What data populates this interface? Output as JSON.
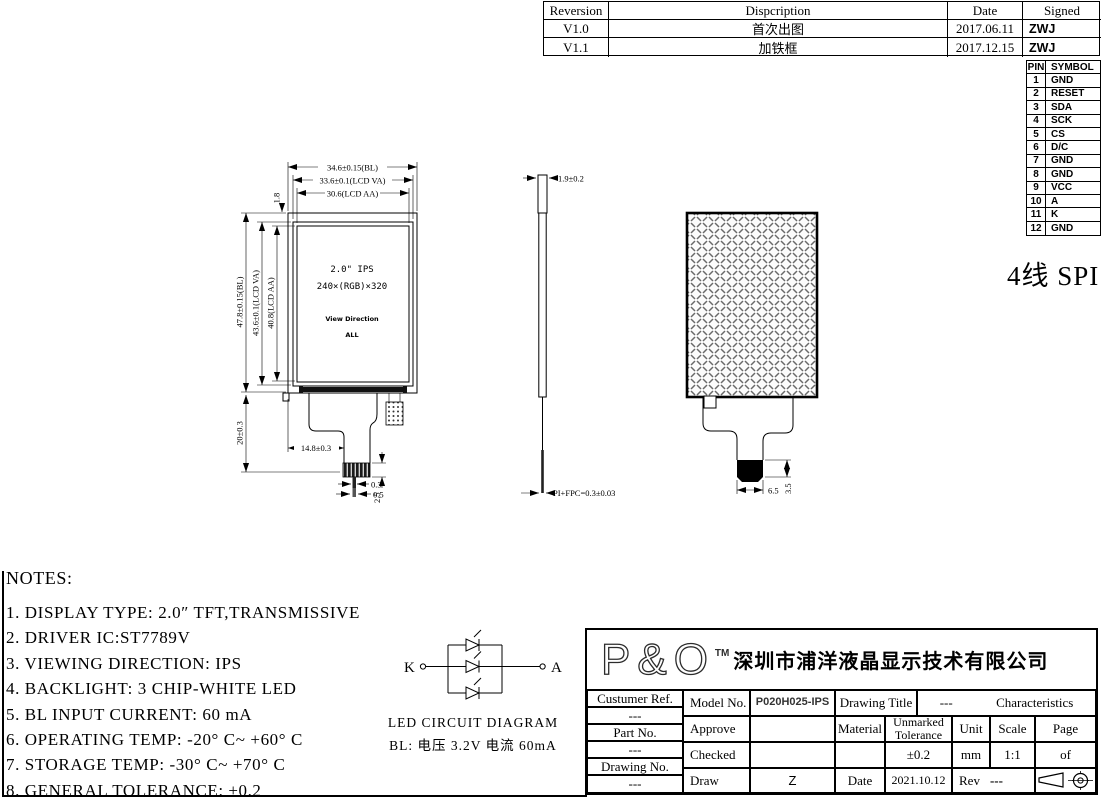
{
  "revision_table": {
    "headers": [
      "Reversion",
      "Dispcription",
      "Date",
      "Signed"
    ],
    "rows": [
      {
        "version": "V1.0",
        "description": "首次出图",
        "date": "2017.06.11",
        "signed": "ZWJ"
      },
      {
        "version": "V1.1",
        "description": "加铁框",
        "date": "2017.12.15",
        "signed": "ZWJ"
      }
    ]
  },
  "pin_table": {
    "pin_header": "PIN",
    "symbol_header": "SYMBOL",
    "pins": [
      [
        "1",
        "GND"
      ],
      [
        "2",
        "RESET"
      ],
      [
        "3",
        "SDA"
      ],
      [
        "4",
        "SCK"
      ],
      [
        "5",
        "CS"
      ],
      [
        "6",
        "D/C"
      ],
      [
        "7",
        "GND"
      ],
      [
        "8",
        "GND"
      ],
      [
        "9",
        "VCC"
      ],
      [
        "10",
        "A"
      ],
      [
        "11",
        "K"
      ],
      [
        "12",
        "GND"
      ]
    ]
  },
  "interface_label": "4线 SPI",
  "front_view": {
    "dim_width_bl": "34.6±0.15(BL)",
    "dim_width_va": "33.6±0.1(LCD VA)",
    "dim_width_aa": "30.6(LCD AA)",
    "dim_top": "1.8",
    "dim_height_bl": "47.8±0.15(BL)",
    "dim_height_va": "43.6±0.1(LCD VA)",
    "dim_height_aa": "40.8(LCD AA)",
    "dim_bottom": "20±0.3",
    "dim_fpc_offset": "14.8±0.3",
    "dim_fpc_w1": "0.3",
    "dim_fpc_w2": "0.5",
    "dim_fpc_len": "2.5",
    "label_size": "2.0\" IPS",
    "label_resolution": "240×(RGB)×320",
    "label_view_direction": "View Direction",
    "label_view_value": "ALL"
  },
  "side_view": {
    "dim_thickness": "1.9±0.2",
    "dim_fpc": "PI+FPC=0.3±0.03"
  },
  "back_view": {
    "dim_connector_w": "6.5",
    "dim_connector_h": "3.5"
  },
  "notes": {
    "title": "NOTES:",
    "items": [
      "1. DISPLAY TYPE: 2.0″ TFT,TRANSMISSIVE",
      "2. DRIVER IC:ST7789V",
      "3. VIEWING DIRECTION: IPS",
      "4. BACKLIGHT: 3 CHIP-WHITE LED",
      "5. BL INPUT CURRENT: 60 mA",
      "6. OPERATING TEMP: -20° C~ +60° C",
      "7. STORAGE TEMP: -30° C~ +70° C",
      "8. GENERAL TOLERANCE: ±0.2"
    ]
  },
  "led_circuit": {
    "label_k": "K",
    "label_a": "A",
    "title": "LED CIRCUIT DIAGRAM",
    "subtitle": "BL: 电压 3.2V 电流 60mA"
  },
  "title_block": {
    "logo": "P&O",
    "logo_tm": "TM",
    "company": "深圳市浦洋液晶显示技术有限公司",
    "customer_ref_label": "Custumer Ref.",
    "customer_ref_value": "---",
    "part_no_label": "Part No.",
    "part_no_value": "---",
    "drawing_no_label": "Drawing No.",
    "drawing_no_value": "---",
    "model_no_label": "Model No.",
    "model_no_value": "P020H025-IPS",
    "drawing_title_label": "Drawing Title",
    "drawing_title_value": "---",
    "characteristics": "Characteristics",
    "approve_label": "Approve",
    "material_label": "Material",
    "unmarked_tolerance_label": "Unmarked Tolerance",
    "unit_label": "Unit",
    "scale_label": "Scale",
    "page_label": "Page",
    "checked_label": "Checked",
    "tolerance_value": "±0.2",
    "unit_value": "mm",
    "scale_value": "1:1",
    "page_value": "of",
    "draw_label": "Draw",
    "draw_value": "Z",
    "date_label": "Date",
    "date_value": "2021.10.12",
    "rev_label": "Rev",
    "rev_value": "---"
  }
}
